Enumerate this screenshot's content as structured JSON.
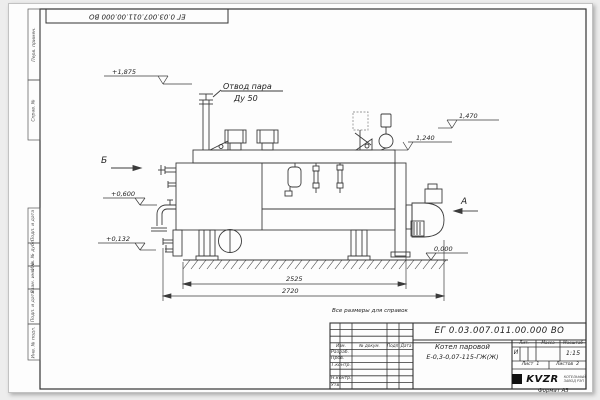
{
  "sheet": {
    "top_stamp": "ЕГ 0.03.007.011.00.000  ВО",
    "note": "Все размеры для справок",
    "format_label": "Формат  А3"
  },
  "margin_labels": {
    "perv_primen": "Перв. примен.",
    "sprav_no": "Справ. №",
    "podp_data_1": "Подп. и дата",
    "inv_dubl": "Инв. № дубл.",
    "vzam_inv": "Взам. инв. №",
    "podp_data_2": "Подп. и дата",
    "inv_podl": "Инв. № подл."
  },
  "title_block": {
    "doc_number": "ЕГ 0.03.007.011.00.000  ВО",
    "product_name_line1": "Котел паровой",
    "product_name_line2": "Е-0,3-0,07-115-ГЖ(Ж)",
    "col_izm": "Изм.",
    "col_list": "Лист",
    "col_docnum": "№ докум.",
    "col_podp": "Подп.",
    "col_data": "Дата",
    "row_razrab": "Разраб.",
    "row_prov": "Пров.",
    "row_tkontr": "Т.контр.",
    "row_nkontr": "Н.контр.",
    "row_utv": "Утв.",
    "lit_label": "Лит.",
    "lit_value": "И",
    "mass_label": "Масса",
    "scale_label": "Масштаб",
    "scale_value": "1:15",
    "sheet_label": "Лист",
    "sheet_value": "1",
    "sheets_label": "Листов",
    "sheets_value": "2",
    "company": "KVZR",
    "company_sub1": "КОТЕЛЬНЫЙ",
    "company_sub2": "ЗАВОД РЭП"
  },
  "drawing": {
    "callout_line1": "Отвод пара",
    "callout_line2": "Ду 50",
    "view_a": "А",
    "view_b": "Б",
    "elevations": {
      "e1875": "+1,875",
      "e1470": "1,470",
      "e1240": "1,240",
      "e0600": "+0,600",
      "e0132": "+0,132",
      "e0000": "0,000"
    },
    "dim_inner": "2525",
    "dim_outer": "2720"
  },
  "colors": {
    "line": "#3b3b3b",
    "sheet": "#fdfdfd",
    "frame": "#333333"
  }
}
